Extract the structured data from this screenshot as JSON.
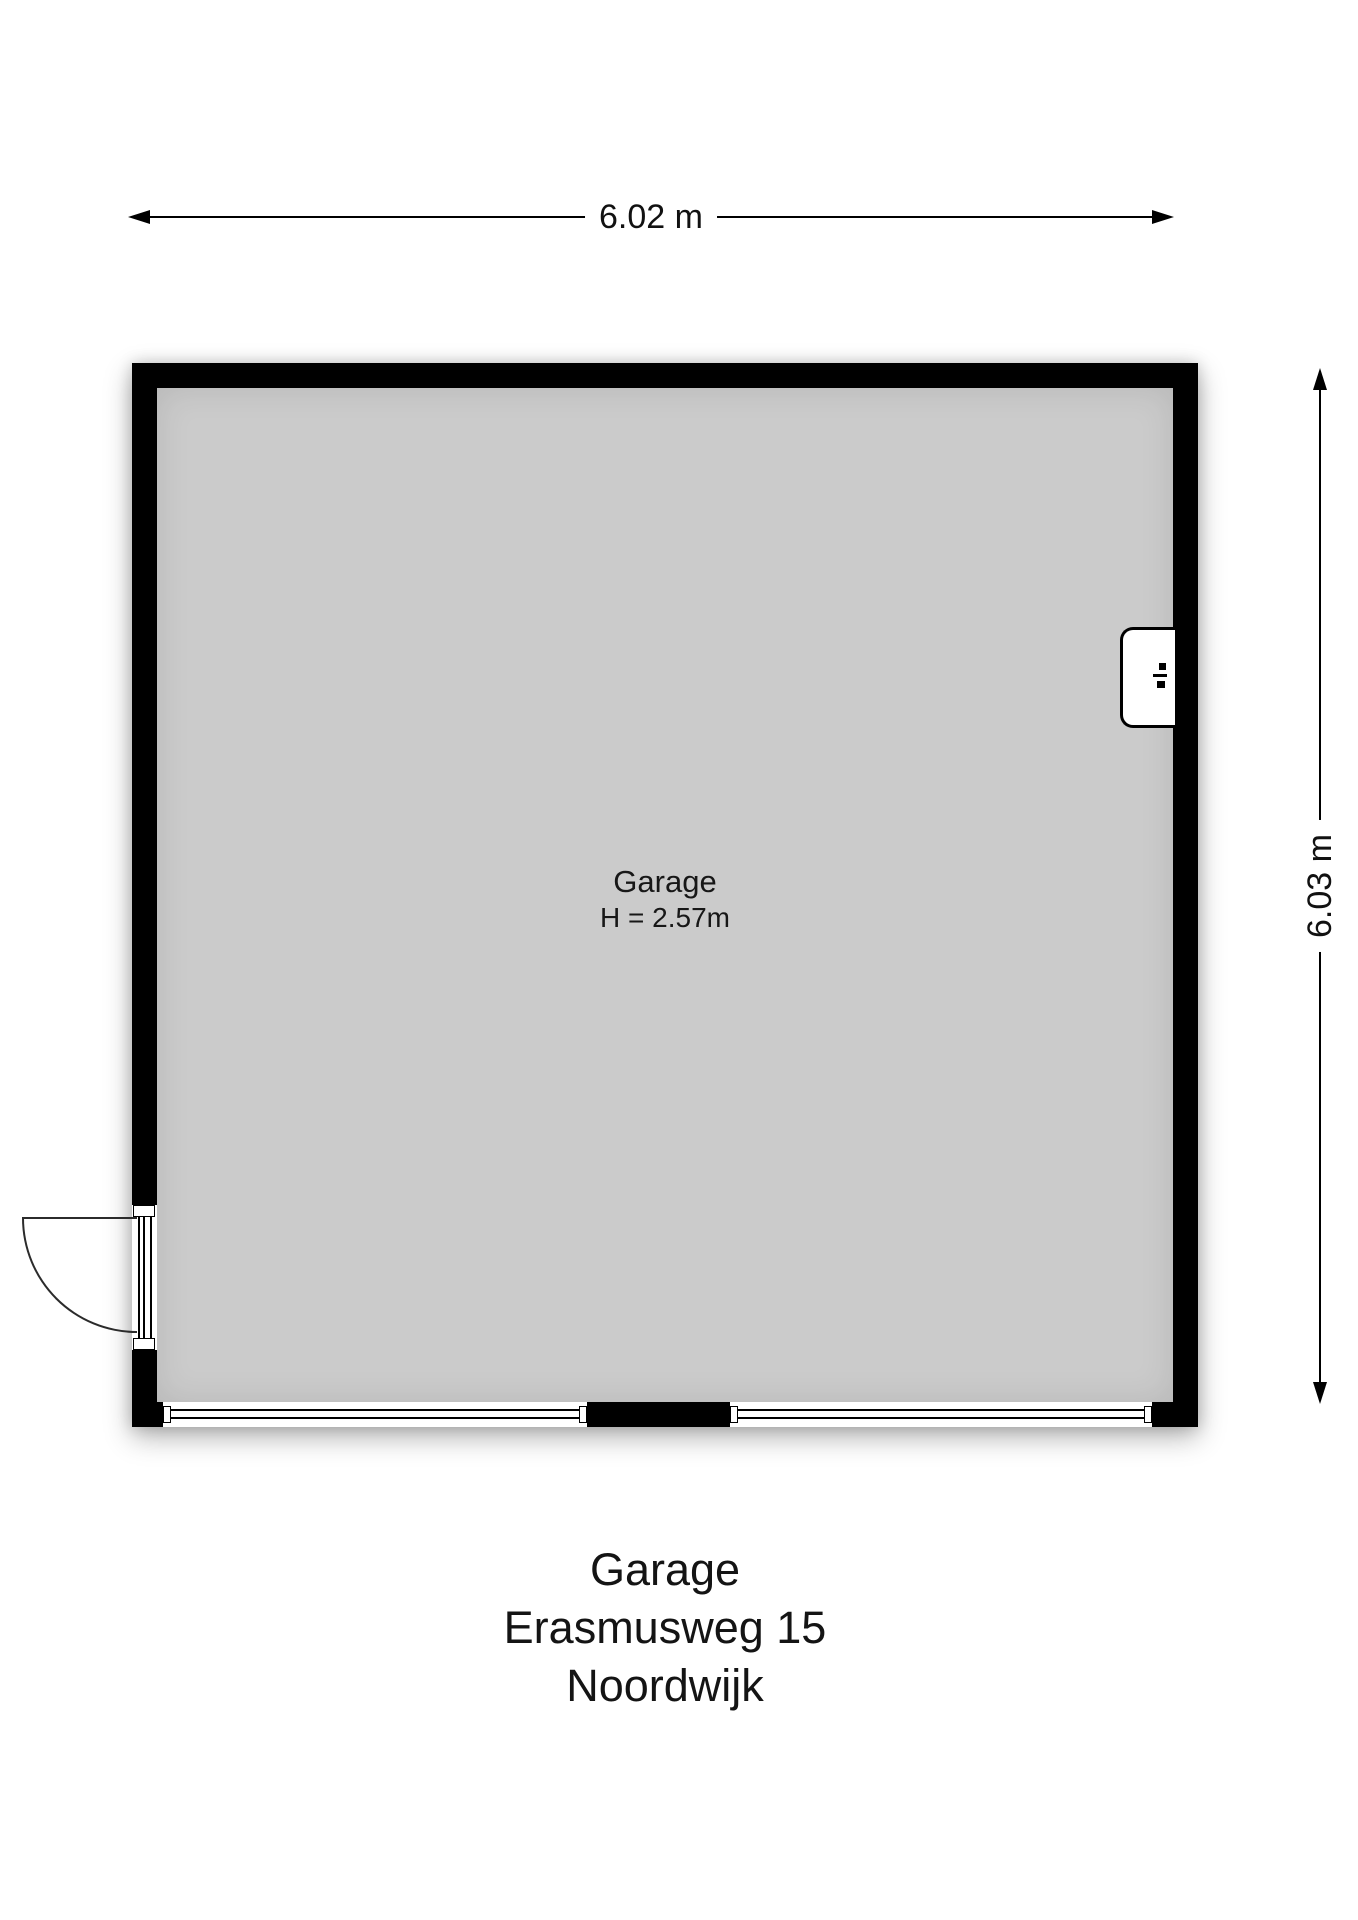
{
  "plan": {
    "room": {
      "name": "Garage",
      "ceiling_height_label": "H = 2.57m"
    },
    "dimensions": {
      "width_label": "6.02 m",
      "height_label": "6.03 m"
    },
    "title_block": {
      "line1": "Garage",
      "line2": "Erasmusweg 15",
      "line3": "Noordwijk"
    },
    "colors": {
      "wall": "#000000",
      "floor": "#cbcbcb",
      "background": "#ffffff",
      "line": "#2b2b2b"
    },
    "features": {
      "wall_unit_icon": "ventilation-unit-icon",
      "entry_door": "single swing door, left wall, opens outward",
      "garage_doors": "two sectional door panels in bottom wall"
    }
  }
}
